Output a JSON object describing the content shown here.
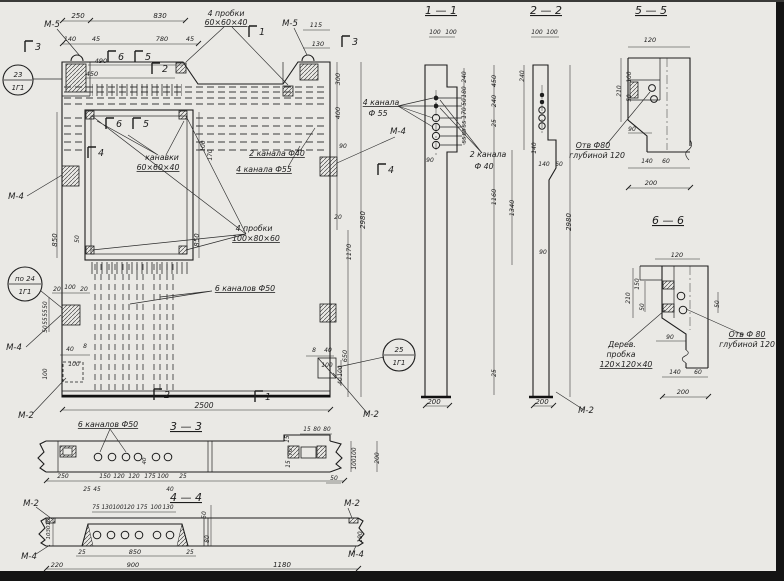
{
  "page": {
    "paper": "#eae9e5",
    "ink": "#1d1d1d",
    "dash_color": "#3a3a3a",
    "edge": "#141414",
    "kind": "scanned engineering drawing, Russian, panel with sections"
  },
  "marks": [
    {
      "top": "23",
      "bottom": "1Г1"
    },
    {
      "top": "по 24",
      "bottom": "1Г1"
    },
    {
      "top": "25",
      "bottom": "1Г1"
    }
  ],
  "flags": [
    {
      "t": "3",
      "x": 38,
      "y": 50
    },
    {
      "t": "3",
      "x": 355,
      "y": 45
    },
    {
      "t": "1",
      "x": 262,
      "y": 35
    },
    {
      "t": "1",
      "x": 268,
      "y": 400
    },
    {
      "t": "2",
      "x": 165,
      "y": 72
    },
    {
      "t": "2",
      "x": 167,
      "y": 398
    },
    {
      "t": "6",
      "x": 121,
      "y": 60
    },
    {
      "t": "5",
      "x": 148,
      "y": 60
    },
    {
      "t": "6",
      "x": 119,
      "y": 127
    },
    {
      "t": "5",
      "x": 146,
      "y": 127
    },
    {
      "t": "4",
      "x": 101,
      "y": 156
    },
    {
      "t": "4",
      "x": 391,
      "y": 173
    }
  ],
  "labels": [
    {
      "t": "1 — 1",
      "x": 441,
      "y": 14,
      "s": 11,
      "u": 1,
      "n": "section-title-1-1"
    },
    {
      "t": "2 — 2",
      "x": 546,
      "y": 14,
      "s": 11,
      "u": 1,
      "n": "section-title-2-2"
    },
    {
      "t": "5 — 5",
      "x": 651,
      "y": 14,
      "s": 11,
      "u": 1,
      "n": "section-title-5-5"
    },
    {
      "t": "6 — 6",
      "x": 668,
      "y": 224,
      "s": 11,
      "u": 1,
      "n": "section-title-6-6"
    },
    {
      "t": "3 — 3",
      "x": 186,
      "y": 430,
      "s": 11,
      "u": 1,
      "n": "section-title-3-3"
    },
    {
      "t": "4 — 4",
      "x": 186,
      "y": 501,
      "s": 11,
      "u": 1,
      "n": "section-title-4-4"
    },
    {
      "t": "М-5",
      "x": 52,
      "y": 27,
      "s": 8.5,
      "n": "mark-ref-label"
    },
    {
      "t": "М-5",
      "x": 290,
      "y": 26,
      "s": 8.5,
      "n": "mark-ref-label"
    },
    {
      "t": "М-4",
      "x": 16,
      "y": 199,
      "s": 8.5,
      "n": "mark-ref-label"
    },
    {
      "t": "М-4",
      "x": 14,
      "y": 350,
      "s": 8.5,
      "n": "mark-ref-label"
    },
    {
      "t": "М-4",
      "x": 398,
      "y": 134,
      "s": 8.5,
      "n": "mark-ref-label"
    },
    {
      "t": "М-2",
      "x": 26,
      "y": 418,
      "s": 8.5,
      "n": "mark-ref-label"
    },
    {
      "t": "М-2",
      "x": 371,
      "y": 417,
      "s": 8.5,
      "n": "mark-ref-label"
    },
    {
      "t": "М-2",
      "x": 586,
      "y": 413,
      "s": 8.5,
      "n": "mark-ref-label"
    },
    {
      "t": "М-2",
      "x": 31,
      "y": 506,
      "s": 8.5,
      "n": "mark-ref-label"
    },
    {
      "t": "М-2",
      "x": 352,
      "y": 506,
      "s": 8.5,
      "n": "mark-ref-label"
    },
    {
      "t": "М-4",
      "x": 29,
      "y": 559,
      "s": 8.5,
      "n": "mark-ref-label"
    },
    {
      "t": "М-4",
      "x": 356,
      "y": 557,
      "s": 8.5,
      "n": "mark-ref-label"
    },
    {
      "t": "4 пробки",
      "x": 226,
      "y": 16,
      "s": 7.8,
      "n": "annotation"
    },
    {
      "t": "60×60×40",
      "x": 226,
      "y": 25,
      "s": 7.8,
      "u": 1,
      "n": "annotation"
    },
    {
      "t": "канавки",
      "x": 162,
      "y": 160,
      "s": 7.8,
      "n": "annotation"
    },
    {
      "t": "60×60×40",
      "x": 158,
      "y": 170,
      "s": 7.8,
      "u": 1,
      "n": "annotation"
    },
    {
      "t": "2 канала Ф40",
      "x": 277,
      "y": 156,
      "s": 7.8,
      "u": 1,
      "n": "annotation"
    },
    {
      "t": "4 канала Ф55",
      "x": 264,
      "y": 172,
      "s": 7.8,
      "u": 1,
      "n": "annotation"
    },
    {
      "t": "4 пробки",
      "x": 254,
      "y": 231,
      "s": 7.8,
      "n": "annotation"
    },
    {
      "t": "100×80×60",
      "x": 256,
      "y": 241,
      "s": 7.8,
      "u": 1,
      "n": "annotation"
    },
    {
      "t": "6 каналов Ф50",
      "x": 245,
      "y": 291,
      "s": 7.8,
      "u": 1,
      "n": "annotation"
    },
    {
      "t": "4 канала",
      "x": 381,
      "y": 105,
      "s": 7.8,
      "u": 1,
      "n": "annotation"
    },
    {
      "t": "Ф 55",
      "x": 378,
      "y": 116,
      "s": 7.8,
      "n": "annotation"
    },
    {
      "t": "2 канала",
      "x": 488,
      "y": 157,
      "s": 7.8,
      "n": "annotation"
    },
    {
      "t": "Ф 40",
      "x": 484,
      "y": 169,
      "s": 7.8,
      "n": "annotation"
    },
    {
      "t": "6 каналов Ф50",
      "x": 108,
      "y": 427,
      "s": 7.8,
      "u": 1,
      "n": "annotation"
    },
    {
      "t": "Отв Ф80",
      "x": 593,
      "y": 148,
      "s": 7.8,
      "u": 1,
      "n": "annotation"
    },
    {
      "t": "глубиной 120",
      "x": 597,
      "y": 158,
      "s": 7.8,
      "n": "annotation"
    },
    {
      "t": "Отв Ф 80",
      "x": 747,
      "y": 337,
      "s": 7.8,
      "u": 1,
      "n": "annotation"
    },
    {
      "t": "глубиной 120",
      "x": 747,
      "y": 347,
      "s": 7.8,
      "n": "annotation"
    },
    {
      "t": "Дерев.",
      "x": 622,
      "y": 347,
      "s": 7.8,
      "n": "annotation"
    },
    {
      "t": "пробка",
      "x": 621,
      "y": 357,
      "s": 7.8,
      "n": "annotation"
    },
    {
      "t": "120×120×40",
      "x": 626,
      "y": 367,
      "s": 7.8,
      "u": 1,
      "n": "annotation"
    },
    {
      "t": "250",
      "x": 78,
      "y": 18,
      "s": 7
    },
    {
      "t": "830",
      "x": 160,
      "y": 18,
      "s": 7
    },
    {
      "t": "140",
      "x": 70,
      "y": 41,
      "s": 6.5
    },
    {
      "t": "45",
      "x": 96,
      "y": 41,
      "s": 6.5
    },
    {
      "t": "780",
      "x": 162,
      "y": 41,
      "s": 6.5
    },
    {
      "t": "45",
      "x": 190,
      "y": 41,
      "s": 6.5
    },
    {
      "t": "490",
      "x": 101,
      "y": 63,
      "s": 6.5
    },
    {
      "t": "450",
      "x": 92,
      "y": 76,
      "s": 6.5
    },
    {
      "t": "115",
      "x": 316,
      "y": 27,
      "s": 6.5
    },
    {
      "t": "130",
      "x": 318,
      "y": 46,
      "s": 6.5
    },
    {
      "t": "850",
      "x": 57,
      "y": 240,
      "r": -90,
      "s": 7
    },
    {
      "t": "850",
      "x": 199,
      "y": 240,
      "r": -90,
      "s": 7
    },
    {
      "t": "50",
      "x": 79,
      "y": 239,
      "r": -90,
      "s": 6
    },
    {
      "t": "100",
      "x": 205,
      "y": 146,
      "r": -90,
      "s": 5.8
    },
    {
      "t": "170",
      "x": 212,
      "y": 155,
      "r": -90,
      "s": 5.8
    },
    {
      "t": "300",
      "x": 340,
      "y": 79,
      "r": -90,
      "s": 6.5
    },
    {
      "t": "400",
      "x": 340,
      "y": 113,
      "r": -90,
      "s": 6.5
    },
    {
      "t": "90",
      "x": 343,
      "y": 148,
      "s": 6
    },
    {
      "t": "20",
      "x": 338,
      "y": 219,
      "s": 6
    },
    {
      "t": "2980",
      "x": 365,
      "y": 220,
      "r": -90,
      "s": 7
    },
    {
      "t": "1170",
      "x": 351,
      "y": 252,
      "r": -90,
      "s": 6.5
    },
    {
      "t": "650",
      "x": 347,
      "y": 356,
      "r": -90,
      "s": 6.5
    },
    {
      "t": "8",
      "x": 314,
      "y": 352,
      "s": 6
    },
    {
      "t": "40",
      "x": 328,
      "y": 352,
      "s": 6
    },
    {
      "t": "100",
      "x": 327,
      "y": 367,
      "s": 6
    },
    {
      "t": "100",
      "x": 342,
      "y": 371,
      "r": -90,
      "s": 5.8
    },
    {
      "t": "40",
      "x": 342,
      "y": 381,
      "r": -90,
      "s": 5.8
    },
    {
      "t": "20",
      "x": 57,
      "y": 291,
      "s": 6
    },
    {
      "t": "100",
      "x": 70,
      "y": 289,
      "s": 6
    },
    {
      "t": "20",
      "x": 84,
      "y": 291,
      "s": 6
    },
    {
      "t": "50",
      "x": 47,
      "y": 305,
      "r": -90,
      "s": 5.8
    },
    {
      "t": "55",
      "x": 47,
      "y": 313,
      "r": -90,
      "s": 5.8
    },
    {
      "t": "55",
      "x": 47,
      "y": 321,
      "r": -90,
      "s": 5.8
    },
    {
      "t": "50",
      "x": 47,
      "y": 329,
      "r": -90,
      "s": 5.8
    },
    {
      "t": "40",
      "x": 70,
      "y": 351,
      "s": 6
    },
    {
      "t": "8",
      "x": 85,
      "y": 348,
      "s": 6
    },
    {
      "t": "100",
      "x": 74,
      "y": 366,
      "s": 6
    },
    {
      "t": "100",
      "x": 47,
      "y": 374,
      "r": -90,
      "s": 5.8
    },
    {
      "t": "2500",
      "x": 204,
      "y": 408,
      "s": 7.5
    },
    {
      "t": "100",
      "x": 435,
      "y": 34,
      "s": 6
    },
    {
      "t": "100",
      "x": 451,
      "y": 34,
      "s": 6
    },
    {
      "t": "240",
      "x": 466,
      "y": 77,
      "r": -90,
      "s": 6
    },
    {
      "t": "180",
      "x": 466,
      "y": 92,
      "r": -90,
      "s": 6
    },
    {
      "t": "50",
      "x": 466,
      "y": 102,
      "r": -90,
      "s": 5.8
    },
    {
      "t": "170",
      "x": 466,
      "y": 113,
      "r": -90,
      "s": 6
    },
    {
      "t": "55",
      "x": 466,
      "y": 124,
      "r": -90,
      "s": 5.5
    },
    {
      "t": "55",
      "x": 466,
      "y": 132,
      "r": -90,
      "s": 5.5
    },
    {
      "t": "55",
      "x": 466,
      "y": 140,
      "r": -90,
      "s": 5.5
    },
    {
      "t": "90",
      "x": 430,
      "y": 162,
      "s": 6
    },
    {
      "t": "450",
      "x": 496,
      "y": 81,
      "r": -90,
      "s": 6.5
    },
    {
      "t": "240",
      "x": 496,
      "y": 101,
      "r": -90,
      "s": 6.5
    },
    {
      "t": "25",
      "x": 496,
      "y": 123,
      "r": -90,
      "s": 6
    },
    {
      "t": "1160",
      "x": 496,
      "y": 197,
      "r": -90,
      "s": 6.5
    },
    {
      "t": "25",
      "x": 496,
      "y": 373,
      "r": -90,
      "s": 6
    },
    {
      "t": "1340",
      "x": 514,
      "y": 208,
      "r": -90,
      "s": 6.5
    },
    {
      "t": "200",
      "x": 434,
      "y": 404,
      "s": 7
    },
    {
      "t": "100",
      "x": 537,
      "y": 34,
      "s": 6
    },
    {
      "t": "100",
      "x": 552,
      "y": 34,
      "s": 6
    },
    {
      "t": "240",
      "x": 524,
      "y": 76,
      "r": -90,
      "s": 6
    },
    {
      "t": "140",
      "x": 536,
      "y": 148,
      "r": -90,
      "s": 6
    },
    {
      "t": "140",
      "x": 544,
      "y": 166,
      "s": 6
    },
    {
      "t": "60",
      "x": 559,
      "y": 166,
      "s": 6
    },
    {
      "t": "90",
      "x": 543,
      "y": 254,
      "s": 6
    },
    {
      "t": "2980",
      "x": 571,
      "y": 222,
      "r": -90,
      "s": 7
    },
    {
      "t": "200",
      "x": 542,
      "y": 404,
      "s": 7
    },
    {
      "t": "120",
      "x": 650,
      "y": 42,
      "s": 6.5
    },
    {
      "t": "100",
      "x": 631,
      "y": 77,
      "r": -90,
      "s": 5.8
    },
    {
      "t": "210",
      "x": 621,
      "y": 91,
      "r": -90,
      "s": 6
    },
    {
      "t": "50",
      "x": 631,
      "y": 98,
      "r": -90,
      "s": 5.8
    },
    {
      "t": "90",
      "x": 632,
      "y": 131,
      "s": 6
    },
    {
      "t": "140",
      "x": 647,
      "y": 163,
      "s": 6
    },
    {
      "t": "60",
      "x": 666,
      "y": 163,
      "s": 6
    },
    {
      "t": "200",
      "x": 651,
      "y": 185,
      "s": 6.5
    },
    {
      "t": "120",
      "x": 677,
      "y": 257,
      "s": 6.5
    },
    {
      "t": "150",
      "x": 639,
      "y": 284,
      "r": -90,
      "s": 6
    },
    {
      "t": "210",
      "x": 630,
      "y": 298,
      "r": -90,
      "s": 6
    },
    {
      "t": "50",
      "x": 644,
      "y": 307,
      "r": -90,
      "s": 5.8
    },
    {
      "t": "50",
      "x": 719,
      "y": 304,
      "r": -90,
      "s": 5.8
    },
    {
      "t": "90",
      "x": 670,
      "y": 339,
      "s": 6
    },
    {
      "t": "140",
      "x": 675,
      "y": 374,
      "s": 6
    },
    {
      "t": "60",
      "x": 698,
      "y": 374,
      "s": 6
    },
    {
      "t": "200",
      "x": 683,
      "y": 394,
      "s": 6.5
    },
    {
      "t": "15",
      "x": 307,
      "y": 431,
      "s": 5.8
    },
    {
      "t": "80",
      "x": 317,
      "y": 431,
      "s": 5.8
    },
    {
      "t": "80",
      "x": 327,
      "y": 431,
      "s": 5.8
    },
    {
      "t": "15",
      "x": 289,
      "y": 439,
      "r": -90,
      "s": 5.8
    },
    {
      "t": "70",
      "x": 292,
      "y": 452,
      "r": -90,
      "s": 5.8
    },
    {
      "t": "15",
      "x": 290,
      "y": 464,
      "r": -90,
      "s": 5.8
    },
    {
      "t": "100",
      "x": 356,
      "y": 453,
      "r": -90,
      "s": 5.8
    },
    {
      "t": "100",
      "x": 356,
      "y": 464,
      "r": -90,
      "s": 5.8
    },
    {
      "t": "200",
      "x": 379,
      "y": 458,
      "r": -90,
      "s": 6
    },
    {
      "t": "50",
      "x": 334,
      "y": 480,
      "s": 6
    },
    {
      "t": "250",
      "x": 63,
      "y": 478,
      "s": 6
    },
    {
      "t": "25",
      "x": 87,
      "y": 491,
      "s": 5.8
    },
    {
      "t": "45",
      "x": 97,
      "y": 491,
      "s": 5.8
    },
    {
      "t": "150",
      "x": 105,
      "y": 478,
      "s": 6
    },
    {
      "t": "120",
      "x": 119,
      "y": 478,
      "s": 6
    },
    {
      "t": "120",
      "x": 134,
      "y": 478,
      "s": 6
    },
    {
      "t": "175",
      "x": 150,
      "y": 478,
      "s": 6
    },
    {
      "t": "100",
      "x": 163,
      "y": 478,
      "s": 6
    },
    {
      "t": "40",
      "x": 170,
      "y": 491,
      "s": 5.8
    },
    {
      "t": "25",
      "x": 183,
      "y": 478,
      "s": 5.8
    },
    {
      "t": "40",
      "x": 146,
      "y": 461,
      "r": -90,
      "s": 5.5
    },
    {
      "t": "75",
      "x": 96,
      "y": 509,
      "s": 5.8
    },
    {
      "t": "130",
      "x": 107,
      "y": 509,
      "s": 5.8
    },
    {
      "t": "100",
      "x": 118,
      "y": 509,
      "s": 5.8
    },
    {
      "t": "120",
      "x": 129,
      "y": 509,
      "s": 5.8
    },
    {
      "t": "175",
      "x": 142,
      "y": 509,
      "s": 5.8
    },
    {
      "t": "100",
      "x": 156,
      "y": 509,
      "s": 5.8
    },
    {
      "t": "130",
      "x": 168,
      "y": 509,
      "s": 5.8
    },
    {
      "t": "10",
      "x": 50,
      "y": 522,
      "r": -90,
      "s": 5.5
    },
    {
      "t": "30",
      "x": 50,
      "y": 529,
      "r": -90,
      "s": 5.5
    },
    {
      "t": "10",
      "x": 50,
      "y": 536,
      "r": -90,
      "s": 5.5
    },
    {
      "t": "50",
      "x": 206,
      "y": 515,
      "r": -90,
      "s": 6
    },
    {
      "t": "80",
      "x": 209,
      "y": 539,
      "r": -90,
      "s": 6
    },
    {
      "t": "190",
      "x": 362,
      "y": 537,
      "r": -90,
      "s": 6
    },
    {
      "t": "25",
      "x": 82,
      "y": 554,
      "s": 5.8
    },
    {
      "t": "850",
      "x": 135,
      "y": 554,
      "s": 6.5
    },
    {
      "t": "25",
      "x": 190,
      "y": 554,
      "s": 5.8
    },
    {
      "t": "220",
      "x": 57,
      "y": 567,
      "s": 6.5
    },
    {
      "t": "900",
      "x": 133,
      "y": 567,
      "s": 6.5
    },
    {
      "t": "1180",
      "x": 282,
      "y": 567,
      "s": 7
    }
  ]
}
